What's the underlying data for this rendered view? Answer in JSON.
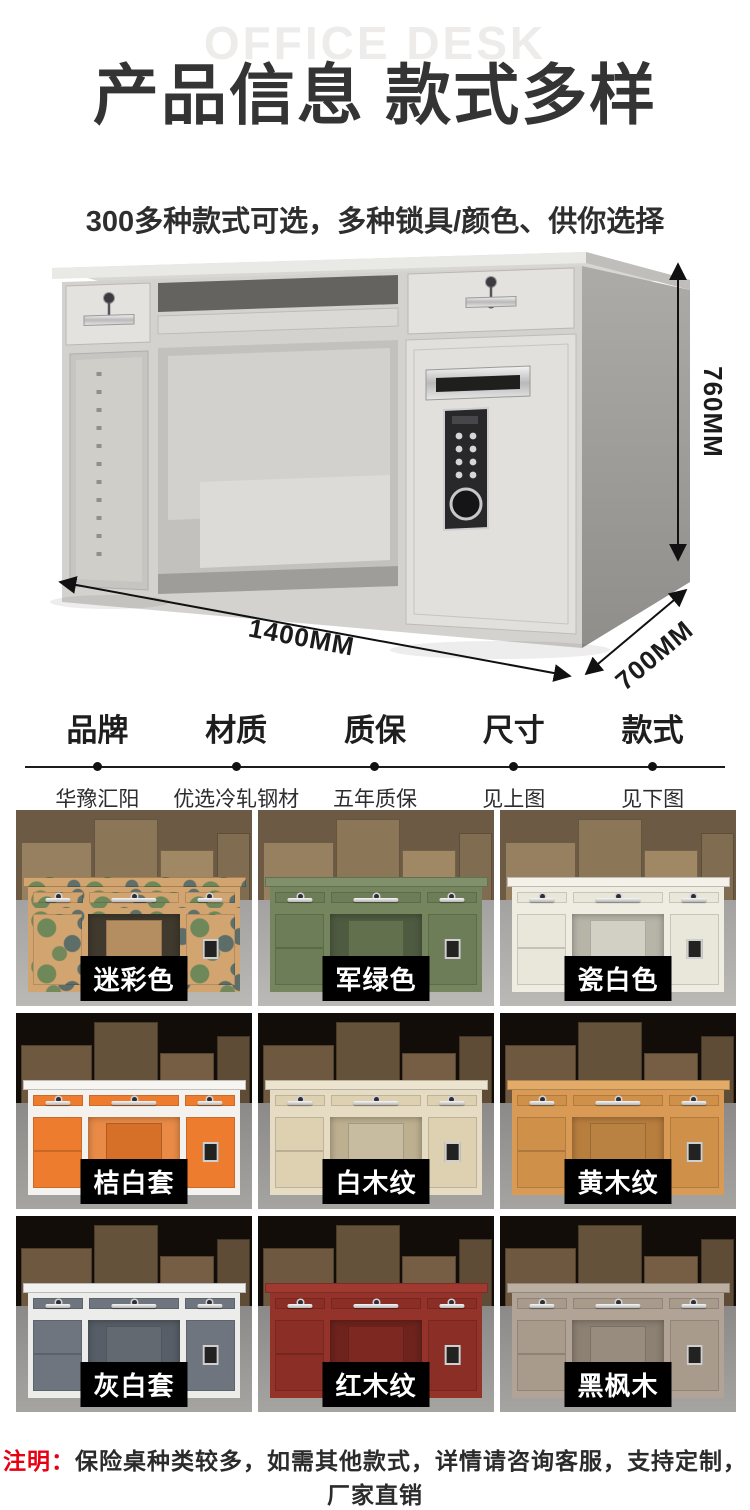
{
  "header": {
    "watermark": "OFFICE DESK",
    "title": "产品信息 款式多样",
    "subtitle": "300多种款式可选，多种锁具/颜色、供你选择"
  },
  "hero": {
    "dimensions": {
      "height": "760MM",
      "width": "1400MM",
      "depth": "700MM"
    }
  },
  "specs": {
    "columns": [
      {
        "label": "品牌",
        "value": "华豫汇阳"
      },
      {
        "label": "材质",
        "value": "优选冷轧钢材"
      },
      {
        "label": "质保",
        "value": "五年质保"
      },
      {
        "label": "尺寸",
        "value": "见上图"
      },
      {
        "label": "款式",
        "value": "见下图"
      }
    ]
  },
  "grid": {
    "items": [
      {
        "label": "迷彩色"
      },
      {
        "label": "军绿色"
      },
      {
        "label": "瓷白色"
      },
      {
        "label": "桔白套"
      },
      {
        "label": "白木纹"
      },
      {
        "label": "黄木纹"
      },
      {
        "label": "灰白套"
      },
      {
        "label": "红木纹"
      },
      {
        "label": "黑枫木"
      }
    ]
  },
  "note": {
    "prefix": "注明：",
    "text": "保险桌种类较多，如需其他款式，详情请咨询客服，支持定制，厂家直销"
  },
  "colors": {
    "accent_red": "#e60012",
    "title_text": "#343434",
    "watermark_gray": "#edecea",
    "label_bg": "#000000",
    "label_text": "#ffffff",
    "desk_gray": "#dcdbd7",
    "camouflage": [
      "#d2a470",
      "#6f885a",
      "#5d6d68"
    ],
    "army_green": "#6d7d57",
    "porcelain_white": "#e9e6da",
    "orange_white": "#ee7c2e",
    "white_wood": "#ddd1b2",
    "yellow_wood": "#cf9049",
    "gray_white": "#6e757e",
    "red_wood": "#8b2e25",
    "black_maple": "#a89b8c"
  }
}
